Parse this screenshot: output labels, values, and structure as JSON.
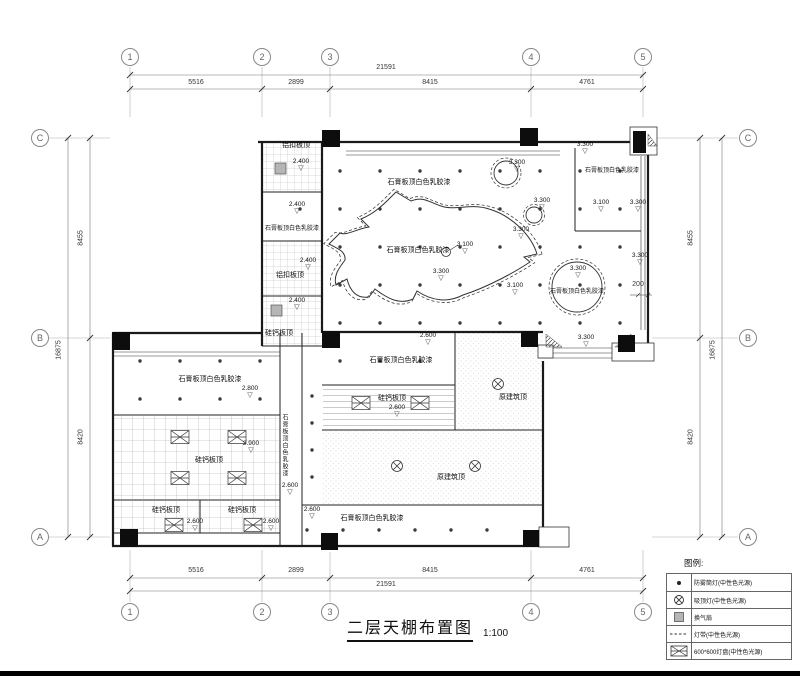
{
  "title": {
    "text": "二层天棚布置图",
    "scale": "1:100"
  },
  "grid": {
    "cols": [
      "1",
      "2",
      "3",
      "4",
      "5"
    ],
    "rows": [
      "C",
      "B",
      "A"
    ]
  },
  "dims": {
    "h_segments": [
      "5516",
      "2899",
      "8415",
      "4761"
    ],
    "h_total": "21591",
    "v_segments": [
      "8455",
      "8420"
    ],
    "v_total": "16875",
    "offset": "200"
  },
  "ceilings": {
    "gypsum": "石膏板顶白色乳胶漆",
    "silicate": "硅钙板顶",
    "aluminum": "铝扣板顶",
    "original": "原建筑顶"
  },
  "elevations": {
    "e2400": "2.400",
    "e2600": "2.600",
    "e2800": "2.800",
    "e2900": "2.900",
    "e3100": "3.100",
    "e3300": "3.300"
  },
  "symbols": {
    "triangle": "▽"
  },
  "legend": {
    "heading": "图例:",
    "items": [
      {
        "icon": "fog-downlight-icon",
        "label": "防雾筒灯(中性色光源)"
      },
      {
        "icon": "ceiling-lamp-icon",
        "label": "吸顶灯(中性色光源)"
      },
      {
        "icon": "vent-fan-icon",
        "label": "换气扇"
      },
      {
        "icon": "light-strip-icon",
        "label": "灯带(中性色光源)"
      },
      {
        "icon": "light-panel-icon",
        "label": "600*600灯盘(中性色光源)"
      }
    ]
  }
}
